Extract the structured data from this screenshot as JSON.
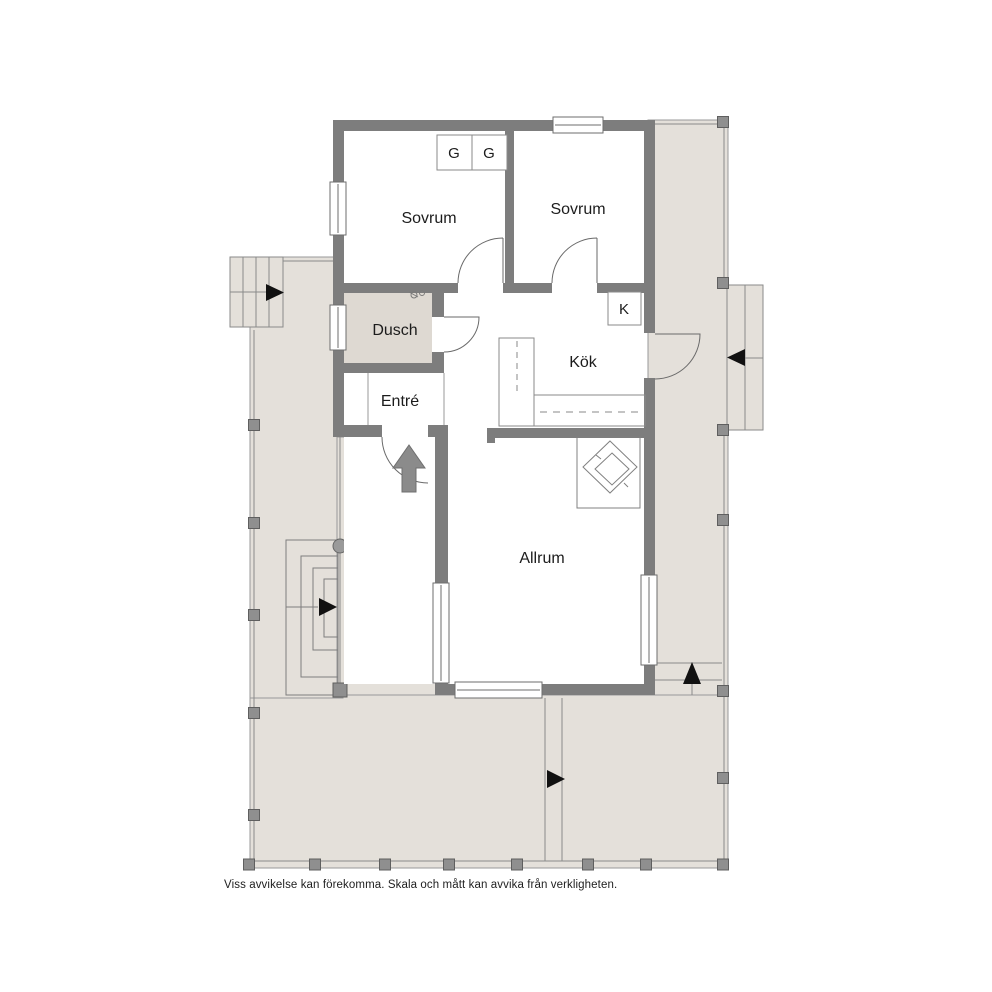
{
  "floorplan": {
    "rooms": [
      {
        "id": "sovrum-left",
        "label": "Sovrum"
      },
      {
        "id": "sovrum-right",
        "label": "Sovrum"
      },
      {
        "id": "dusch",
        "label": "Dusch"
      },
      {
        "id": "entre",
        "label": "Entré"
      },
      {
        "id": "kok",
        "label": "Kök"
      },
      {
        "id": "allrum",
        "label": "Allrum"
      }
    ],
    "fixtures": {
      "wardrobe_left": "G",
      "wardrobe_right": "G",
      "fridge": "K"
    },
    "colors": {
      "wall": "#7d7d7d",
      "deck_floor": "#e4e0da",
      "wet_room_floor": "#ded9d2",
      "room_floor": "#ffffff",
      "thin_line": "#8a8a8a",
      "direction_arrow": "#111111",
      "entrance_arrow": "#8b8b8b"
    },
    "disclaimer": "Viss avvikelse kan förekomma. Skala och mått kan avvika från verkligheten."
  }
}
